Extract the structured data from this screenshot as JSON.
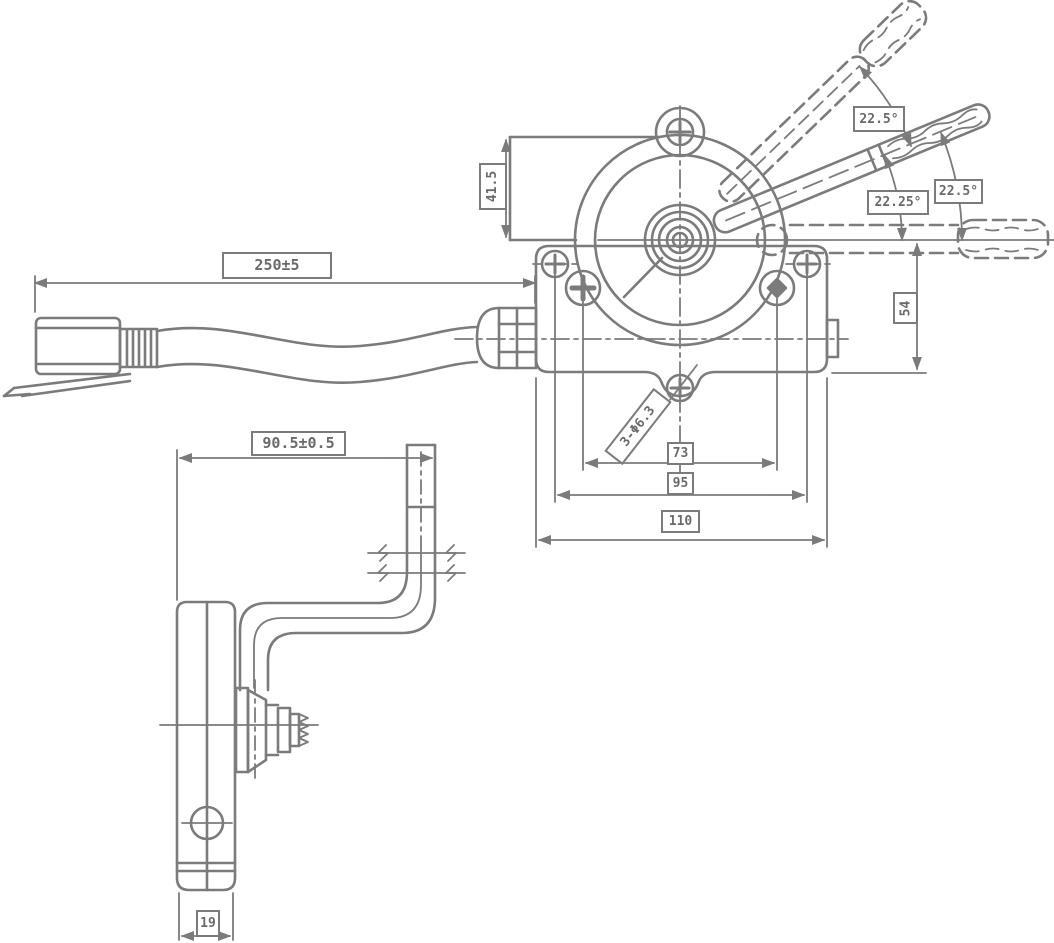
{
  "drawing": {
    "kind": "engineering-drawing",
    "subject": "lever control assembly with cable, gear housing and mounting bracket",
    "colors": {
      "background": "#ffffff",
      "line": "#7b7b7b",
      "text": "#6a6a6a"
    },
    "dimensions": {
      "cable_length": "250±5",
      "housing_side": "41.5",
      "angle_upper": "22.5°",
      "angle_middle": "22.25°",
      "angle_lower": "22.5°",
      "pivot_height": "54",
      "hole_callout": "3-Φ6.3",
      "hole_spacing": "73",
      "screw_spacing": "95",
      "body_width": "110",
      "bracket_offset": "90.5±0.5",
      "bracket_width": "19"
    }
  }
}
